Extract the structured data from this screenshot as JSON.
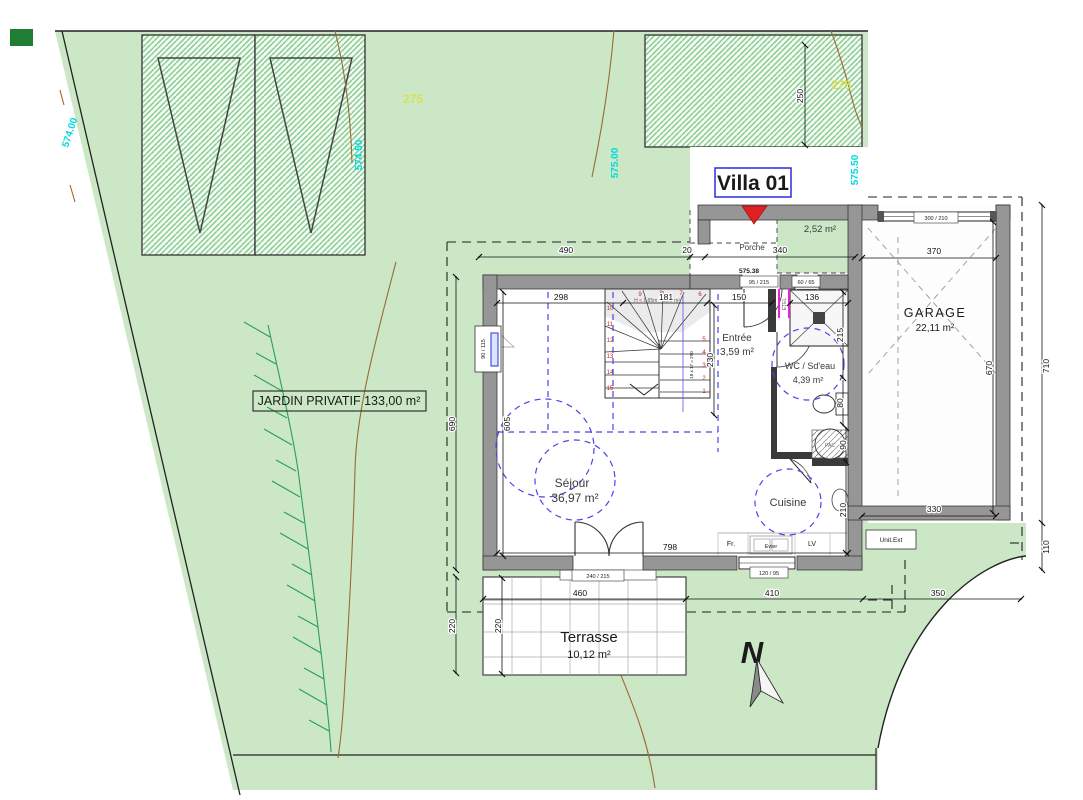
{
  "villa": {
    "title": "Villa 01"
  },
  "site": {
    "jardin_label": "JARDIN PRIVATIF 133,00 m²",
    "north_label": "N",
    "parcel_number_left": "275",
    "parcel_number_right": "275",
    "levels": {
      "left": "574.00",
      "parking": "574.50",
      "center": "575.00",
      "entrance": "575.50",
      "threshold": "575.38"
    }
  },
  "rooms": {
    "porche": {
      "name": "Porche",
      "area": "2,52 m²"
    },
    "entree": {
      "name": "Entrée",
      "area": "3,59 m²"
    },
    "wc": {
      "name": "WC / Sd'eau",
      "area": "4,39 m²"
    },
    "garage": {
      "name": "GARAGE",
      "area": "22,11 m²"
    },
    "sejour": {
      "name": "Séjour",
      "area": "36,97 m²"
    },
    "cuisine": {
      "name": "Cuisine"
    },
    "terrasse": {
      "name": "Terrasse",
      "area": "10,12 m²"
    }
  },
  "stairs": {
    "note": "H < 1,85m = 2,90 m²",
    "calc": "18 x 17 = 290",
    "steps_right": [
      "1",
      "2",
      "3",
      "4",
      "5"
    ],
    "steps_top": [
      "6",
      "7",
      "8",
      "9"
    ],
    "steps_left": [
      "10",
      "11",
      "12",
      "13",
      "14",
      "15"
    ]
  },
  "fixtures": {
    "electrical_panel": "ETEL",
    "exterior_unit": "Unit.Ext",
    "heat_pump": "PAC",
    "fridge": "Fr.",
    "sink": "Evier",
    "dishwasher": "LV"
  },
  "openings": {
    "front_door": "95 / 215",
    "wc_window": "60 / 65",
    "sejour_window": "90 / 115",
    "french_door": "240 / 215",
    "kitchen_window": "120 / 95",
    "garage_door": "300 / 210"
  },
  "dims": {
    "top_left": "490",
    "top_gap": "20",
    "top_porch": "340",
    "parking_depth": "250",
    "sejour_w": "298",
    "stair_w": "181",
    "entree_w": "150",
    "shower_w": "136",
    "entree_d": "230",
    "wc_d": "215",
    "wc_lower": "80",
    "pac_w": "90",
    "kitchen_d": "210",
    "garage_top": "370",
    "garage_bottom": "330",
    "garage_inner": "670",
    "right_outer": "710",
    "right_lower": "110",
    "left_outer": "690",
    "left_inner": "605",
    "sejour_bottom": "798",
    "terrace_w": "460",
    "path_w": "410",
    "drive_w": "350",
    "terrace_d_outer": "220",
    "terrace_d_inner": "220"
  },
  "colors": {
    "site_green": "#cbe7c6",
    "accent_blue": "#2323dd",
    "level_cyan": "#00d9e0",
    "parcel_yellow": "#d8e24d",
    "marker_red": "#e02020"
  }
}
